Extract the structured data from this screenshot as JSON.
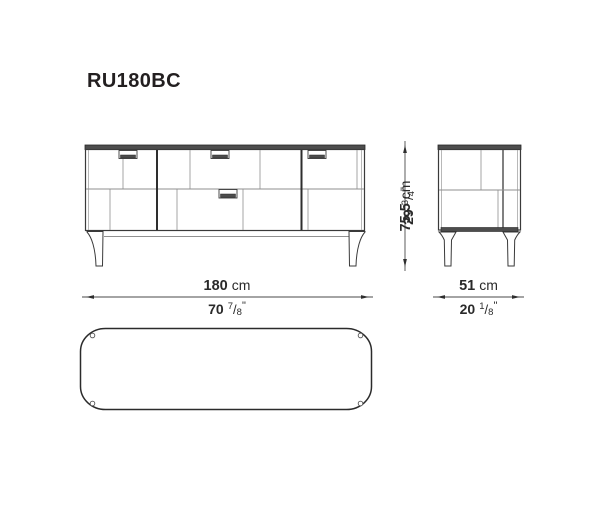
{
  "title": "RU180BC",
  "colors": {
    "line_dark": "#3a3a3a",
    "line_light": "#8f8f8f",
    "panel_fill": "#4d4d4d",
    "text": "#231f20",
    "background": "#ffffff"
  },
  "glyphs": {
    "fraction_slash": "/",
    "inch_mark": "\""
  },
  "dimensions": {
    "width": {
      "metric_value": "180",
      "metric_unit": "cm",
      "imperial_whole": "70",
      "imperial_numerator": "7",
      "imperial_denominator": "8"
    },
    "height": {
      "metric_value": "75,5",
      "metric_unit": "cm",
      "imperial_whole": "29",
      "imperial_numerator": "3",
      "imperial_denominator": "4"
    },
    "depth": {
      "metric_value": "51",
      "metric_unit": "cm",
      "imperial_whole": "20",
      "imperial_numerator": "1",
      "imperial_denominator": "8"
    }
  }
}
